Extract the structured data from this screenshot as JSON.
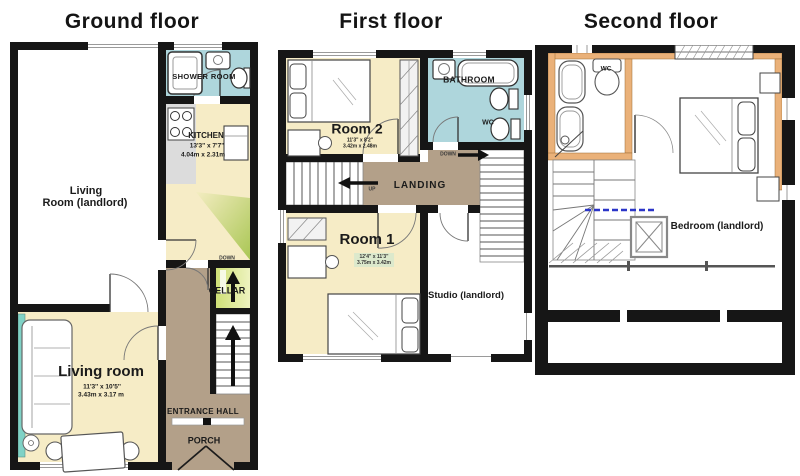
{
  "image_type": "floorplan",
  "colors": {
    "wall": "#161616",
    "room_yellow": "#f6ecc6",
    "room_blue": "#aed6dc",
    "hall_brown": "#b3a089",
    "cellar_green": "#c8d86a",
    "bay_teal": "#7fd2c6",
    "wood_accent": "#eab179",
    "dims_highlight": "#dce9cc"
  },
  "floors": {
    "ground": {
      "title": "Ground floor",
      "labels": {
        "living_room_landlord_l1": "Living",
        "living_room_landlord_l2": "Room (landlord)",
        "shower_room": "SHOWER ROOM",
        "kitchen": "KITCHEN",
        "kitchen_dims_ft": "13'3\" x 7'7\"",
        "kitchen_dims_m": "4.04m x 2.31m",
        "down": "DOWN",
        "cellar": "CELLAR",
        "living_room": "Living room",
        "living_room_dims_ft": "11'3'' x 10'5''",
        "living_room_dims_m": "3.43m x 3.17 m",
        "entrance_hall": "ENTRANCE HALL",
        "porch": "PORCH"
      }
    },
    "first": {
      "title": "First floor",
      "labels": {
        "room2": "Room 2",
        "room2_dims_ft": "11'3\" x 8'2\"",
        "room2_dims_m": "3.42m x 2.48m",
        "bathroom": "BATHROOM",
        "wc": "WC",
        "down": "DOWN",
        "up": "UP",
        "landing": "LANDING",
        "room1": "Room 1",
        "room1_dims_ft": "12'4\" x 11'3\"",
        "room1_dims_m": "3.75m x 3.42m",
        "studio": "Studio (landlord)"
      }
    },
    "second": {
      "title": "Second floor",
      "labels": {
        "wc": "WC",
        "bedroom": "Bedroom (landlord)"
      }
    }
  }
}
